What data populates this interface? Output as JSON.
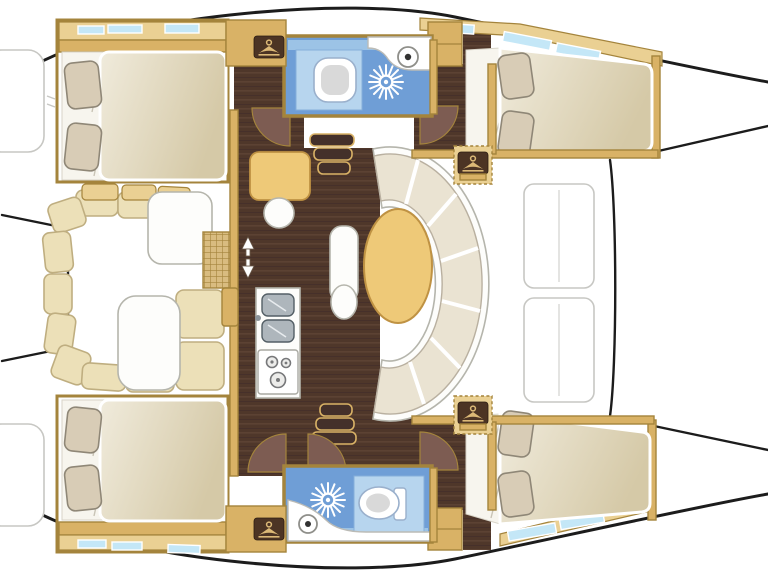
{
  "diagram": {
    "title": "Catamaran sailboat interior layout floor plan, top view, bow to the right",
    "type": "boat-floor-plan",
    "orientation": {
      "bow": "right",
      "stern": "left"
    },
    "rooms": [
      {
        "id": "cabin-port-aft",
        "name": "Port aft double cabin",
        "position": "top-left",
        "features": [
          "double berth",
          "two pillows",
          "hull window strip",
          "hanging locker"
        ]
      },
      {
        "id": "cabin-port-fwd",
        "name": "Port forward double cabin",
        "position": "top-right",
        "features": [
          "tapered double berth",
          "two pillows",
          "hull window strip",
          "hanging locker"
        ]
      },
      {
        "id": "head-port",
        "name": "Port head / bathroom",
        "position": "top-center",
        "features": [
          "marine toilet",
          "shower",
          "washbasin vanity"
        ]
      },
      {
        "id": "saloon",
        "name": "Saloon",
        "position": "center",
        "features": [
          "curved 7-section settee",
          "oval dining table",
          "side table with stool",
          "bench seat",
          "companionway steps to each hull"
        ]
      },
      {
        "id": "galley",
        "name": "Galley",
        "position": "center-bottom",
        "features": [
          "double sink",
          "three-burner stove"
        ]
      },
      {
        "id": "cockpit",
        "name": "Aft cockpit",
        "position": "left-center",
        "features": [
          "U-shaped bench seating",
          "two tables",
          "teak grating",
          "companionway door with up/down arrows"
        ]
      },
      {
        "id": "head-starboard",
        "name": "Starboard head / bathroom",
        "position": "bottom-center",
        "features": [
          "marine toilet",
          "shower",
          "washbasin vanity"
        ]
      },
      {
        "id": "cabin-starboard-aft",
        "name": "Starboard aft double cabin",
        "position": "bottom-left",
        "features": [
          "double berth",
          "two pillows",
          "hull window strip",
          "hanging locker"
        ]
      },
      {
        "id": "cabin-starboard-fwd",
        "name": "Starboard forward double cabin",
        "position": "bottom-right",
        "features": [
          "tapered double berth",
          "two pillows",
          "hull window strip",
          "hanging locker"
        ]
      }
    ],
    "fixture_counts": {
      "berths": 4,
      "toilets": 2,
      "showers": 2,
      "sinks_bath": 2,
      "galley_sinks": 2,
      "stove_burners": 3,
      "door_swings": 5,
      "hanging_locker_icons": 4
    },
    "palette": {
      "outline": "#1c1c1c",
      "wall": "#d9b266",
      "wall-dark": "#a4843c",
      "wall-light": "#ead093",
      "window": "#c4e7f7",
      "floor": "#4f372a",
      "floor-streak": "#5c4233",
      "door-leaf": "#7d5c52",
      "sheet": "#f7f5ee",
      "pillow": "#d8ccb6",
      "pillow-line": "#8f8777",
      "cockpit-cushion": "#ece0b8",
      "cushion-line": "#bfae80",
      "surface-white": "#fdfdfb",
      "surface-line": "#b5b5ac",
      "table-wood": "#eec978",
      "table-wood-line": "#bf9243",
      "blue-deep": "#6f9ed6",
      "blue-mid": "#9cc3e6",
      "blue-light": "#b7d5ee",
      "steel": "#aeb6bc",
      "steel-dark": "#545f66",
      "grating": "#d9bc80",
      "gray-outline": "#c7c7c3"
    }
  }
}
